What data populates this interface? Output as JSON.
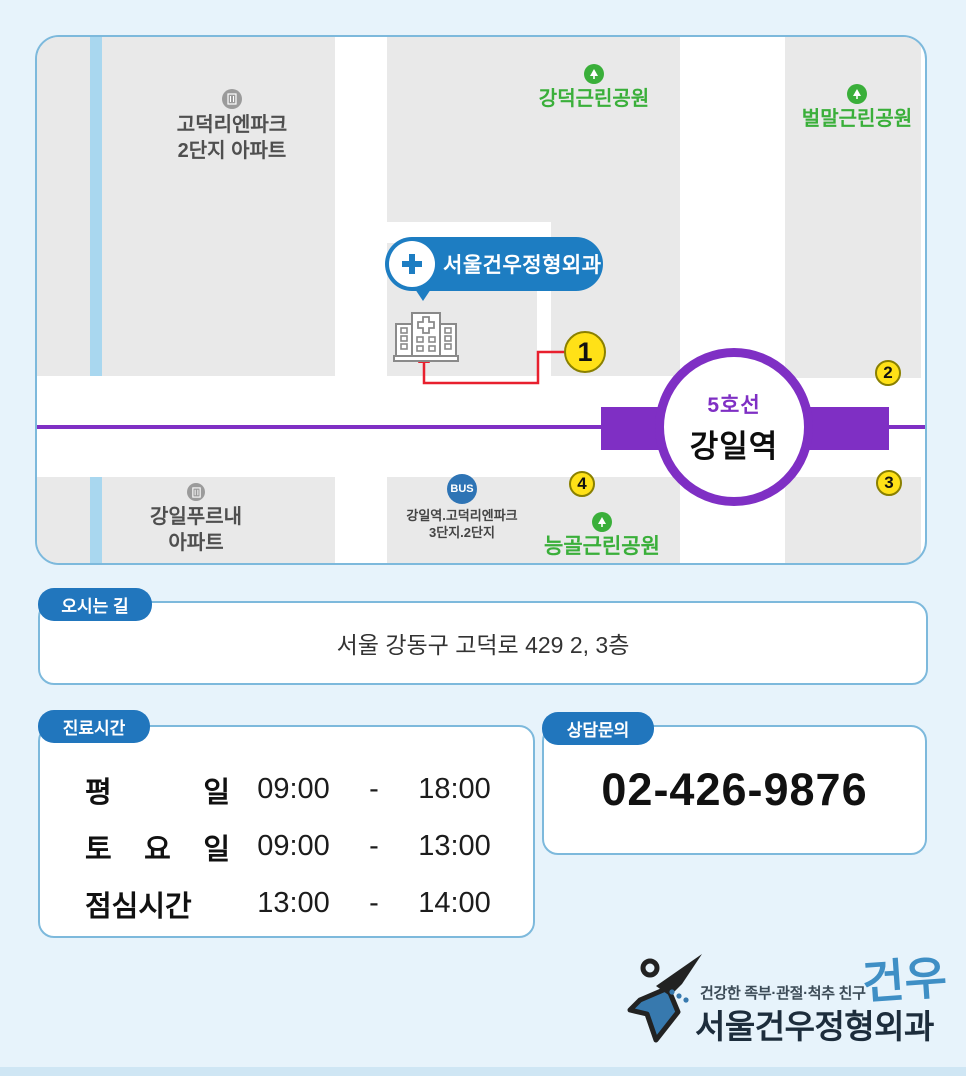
{
  "colors": {
    "page_bg": "#e7f3fb",
    "accent_blue": "#2176bd",
    "marker_bubble_blue": "#1d7dc2",
    "subway_purple": "#7f2fc4",
    "park_green": "#3aaf3a",
    "marker_yellow": "#ffe117",
    "route_red": "#e8202e",
    "bus_blue": "#2e74b5",
    "block_gray": "#e9e9e9",
    "border_light_blue": "#7db9dc"
  },
  "map": {
    "apartment_1": {
      "line1": "고덕리엔파크",
      "line2": "2단지 아파트"
    },
    "apartment_2": {
      "line1": "강일푸르내",
      "line2": "아파트"
    },
    "park_1": "강덕근린공원",
    "park_2": "벌말근린공원",
    "park_3": "능골근린공원",
    "bus_stop": {
      "badge": "BUS",
      "line1": "강일역.고덕리엔파크",
      "line2": "3단지.2단지"
    },
    "clinic_marker": "서울건우정형외과",
    "station": {
      "line": "5호선",
      "name": "강일역"
    },
    "markers": [
      "1",
      "2",
      "3",
      "4"
    ]
  },
  "directions": {
    "tab": "오시는 길",
    "address": "서울 강동구 고덕로 429 2, 3층"
  },
  "hours": {
    "tab": "진료시간",
    "separator": "-",
    "rows": [
      {
        "label": "평 일",
        "start": "09:00",
        "end": "18:00"
      },
      {
        "label": "토 요 일",
        "start": "09:00",
        "end": "13:00"
      },
      {
        "label": "점심시간",
        "start": "13:00",
        "end": "14:00"
      }
    ]
  },
  "contact": {
    "tab": "상담문의",
    "phone": "02-426-9876"
  },
  "footer": {
    "tagline": "건강한 족부·관절·척추 친구",
    "clinic_name": "서울건우정형외과",
    "signature": "건우"
  }
}
